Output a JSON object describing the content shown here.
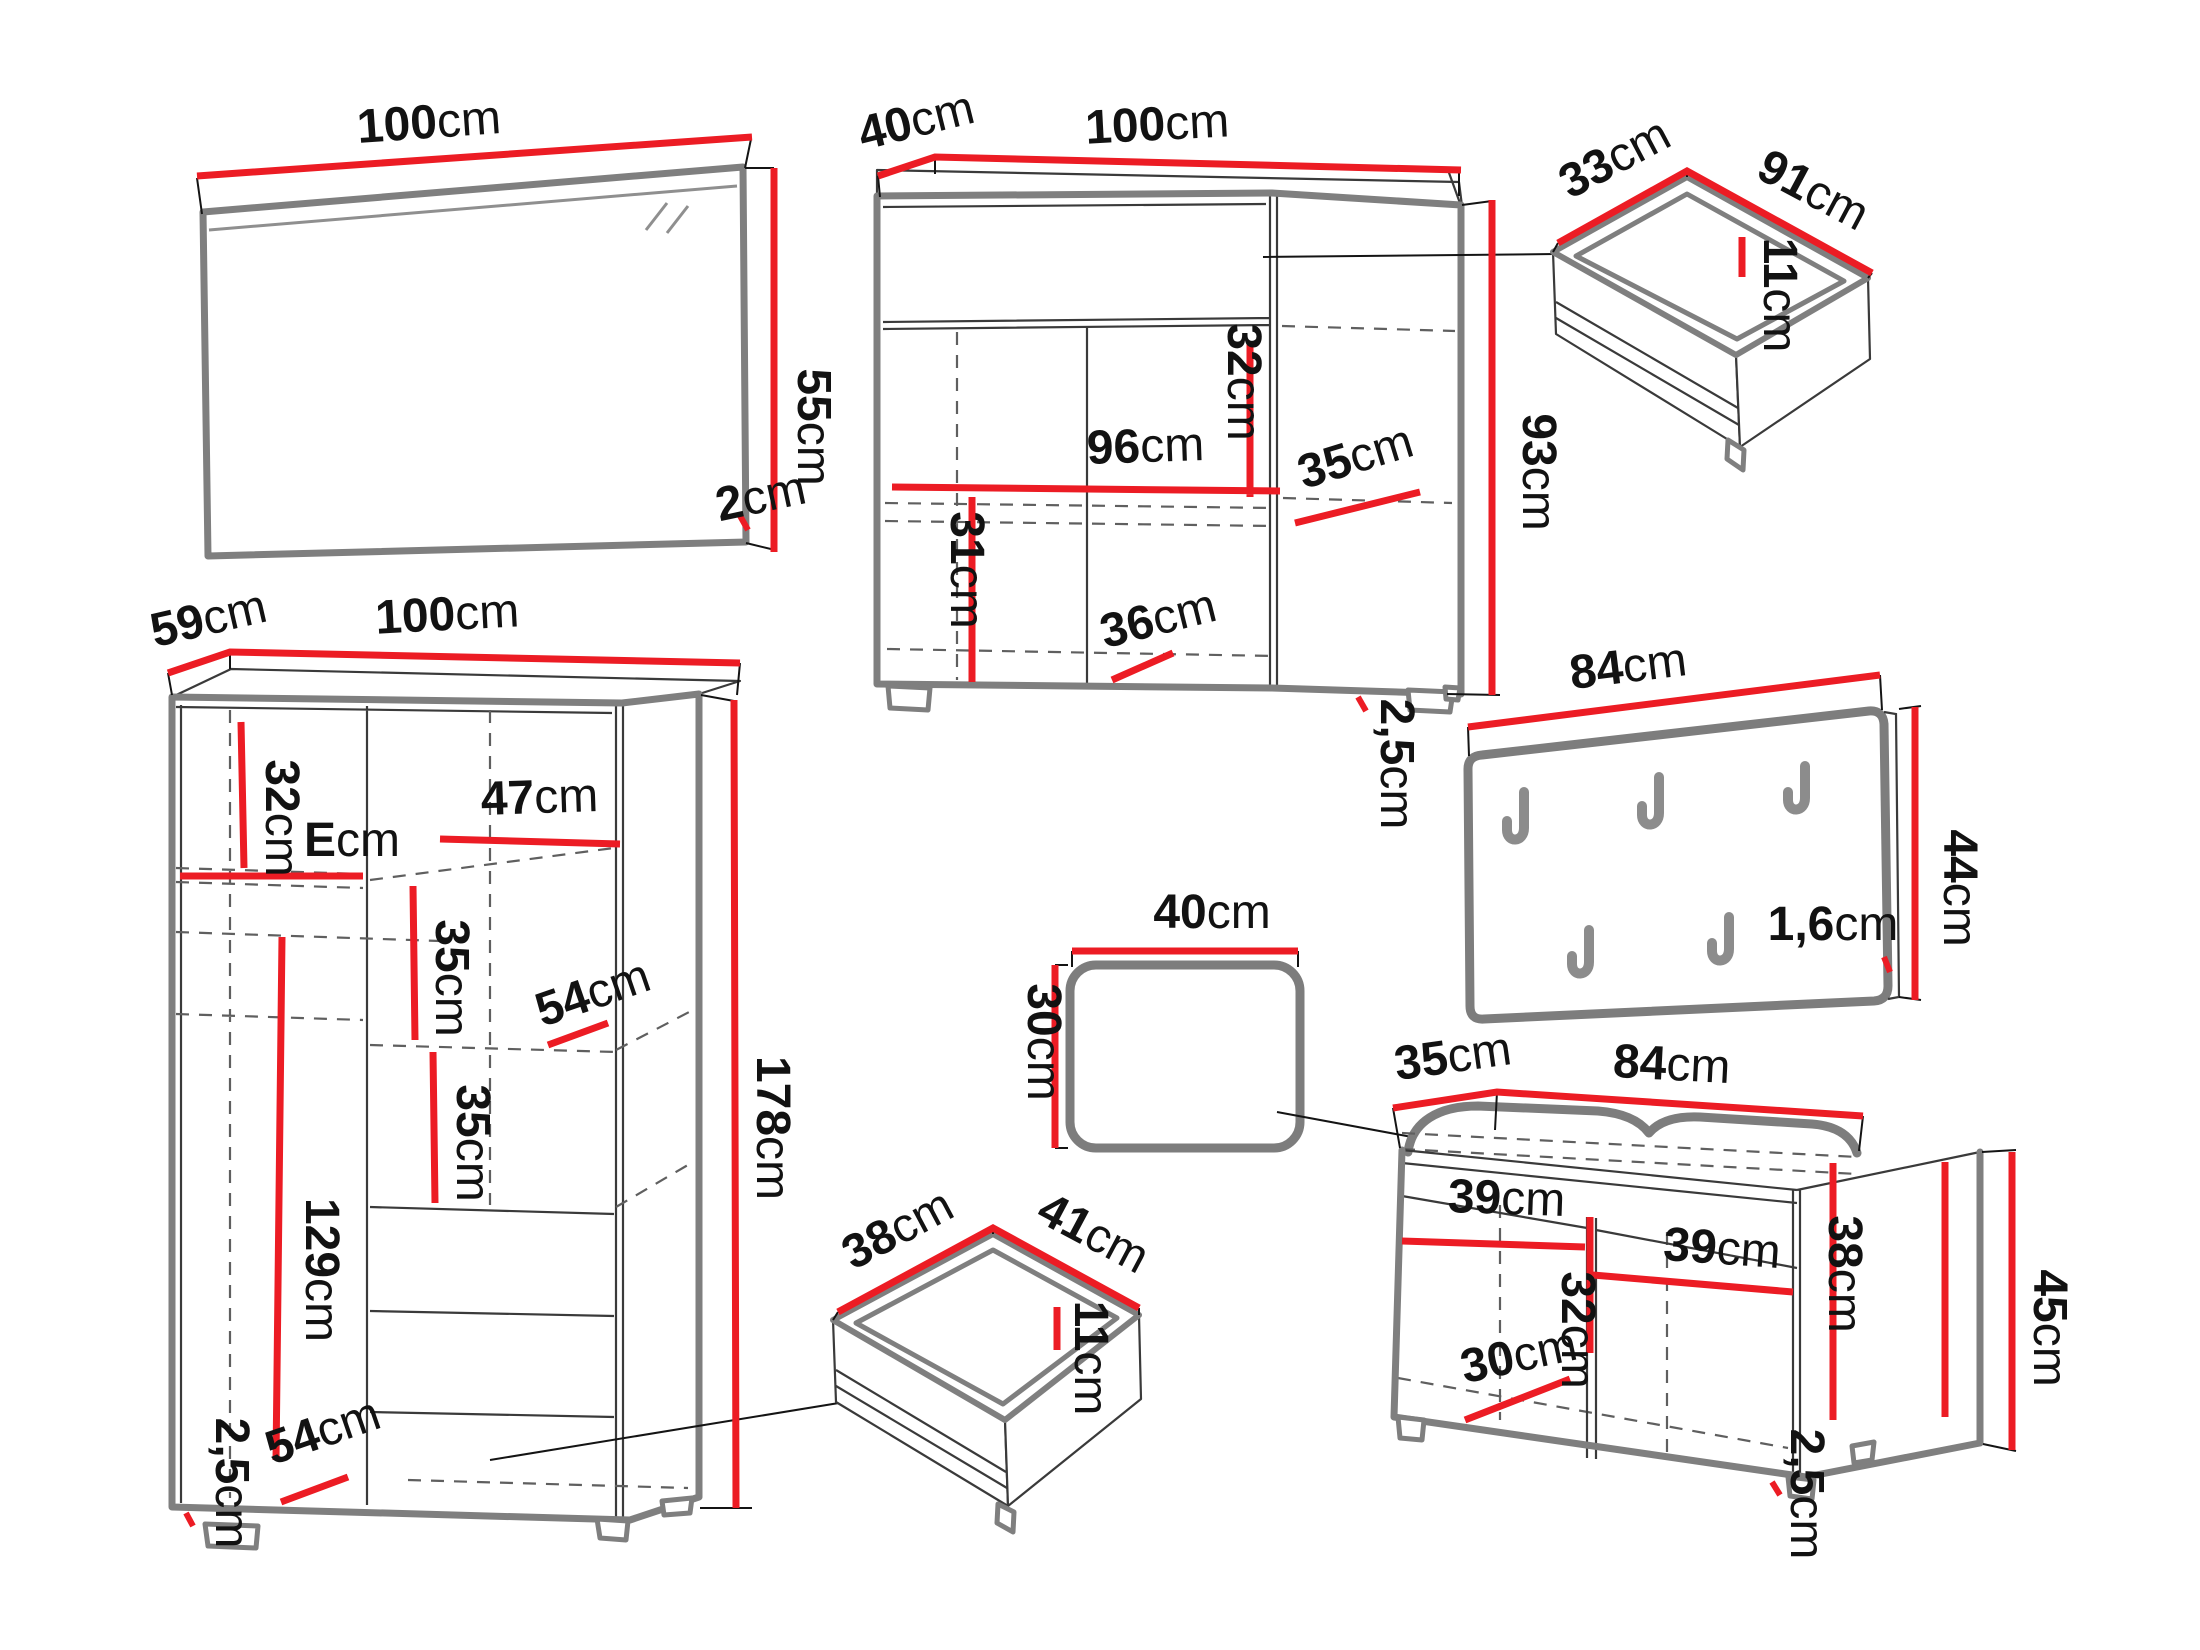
{
  "diagram": {
    "colors": {
      "dimension": "#ec1c24",
      "outline": "#7f7f7f",
      "detail": "#3a3a3a"
    },
    "mirror": {
      "width": {
        "v": "100",
        "u": "cm"
      },
      "height": {
        "v": "55",
        "u": "cm"
      },
      "thickness": {
        "v": "2",
        "u": "cm"
      }
    },
    "sideboard": {
      "depth": {
        "v": "40",
        "u": "cm"
      },
      "width": {
        "v": "100",
        "u": "cm"
      },
      "inner_width": {
        "v": "96",
        "u": "cm"
      },
      "top_inner_height": {
        "v": "32",
        "u": "cm"
      },
      "inner_depth": {
        "v": "35",
        "u": "cm"
      },
      "height": {
        "v": "93",
        "u": "cm"
      },
      "bottom_inner_height": {
        "v": "31",
        "u": "cm"
      },
      "bottom_inner_width": {
        "v": "36",
        "u": "cm"
      },
      "plinth": {
        "v": "2,5",
        "u": "cm"
      }
    },
    "drawer_top": {
      "depth": {
        "v": "33",
        "u": "cm"
      },
      "width": {
        "v": "91",
        "u": "cm"
      },
      "height": {
        "v": "11",
        "u": "cm"
      }
    },
    "coat_rack": {
      "width": {
        "v": "84",
        "u": "cm"
      },
      "height": {
        "v": "44",
        "u": "cm"
      },
      "thickness": {
        "v": "1,6",
        "u": "cm"
      }
    },
    "wardrobe": {
      "depth": {
        "v": "59",
        "u": "cm"
      },
      "width": {
        "v": "100",
        "u": "cm"
      },
      "top_shelf_height": {
        "v": "32",
        "u": "cm"
      },
      "left_width": {
        "v": "E",
        "u": "cm"
      },
      "right_width": {
        "v": "47",
        "u": "cm"
      },
      "shelf_gap_upper": {
        "v": "35",
        "u": "cm"
      },
      "shelf_depth_upper": {
        "v": "54",
        "u": "cm"
      },
      "shelf_gap_lower": {
        "v": "35",
        "u": "cm"
      },
      "hanging_height": {
        "v": "129",
        "u": "cm"
      },
      "height": {
        "v": "178",
        "u": "cm"
      },
      "shelf_depth_lower": {
        "v": "54",
        "u": "cm"
      },
      "plinth": {
        "v": "2,5",
        "u": "cm"
      }
    },
    "stool": {
      "width": {
        "v": "40",
        "u": "cm"
      },
      "height": {
        "v": "30",
        "u": "cm"
      }
    },
    "drawer_bottom": {
      "depth": {
        "v": "38",
        "u": "cm"
      },
      "width": {
        "v": "41",
        "u": "cm"
      },
      "height": {
        "v": "11",
        "u": "cm"
      }
    },
    "bench": {
      "depth": {
        "v": "35",
        "u": "cm"
      },
      "width": {
        "v": "84",
        "u": "cm"
      },
      "left_inner_width": {
        "v": "39",
        "u": "cm"
      },
      "right_inner_width": {
        "v": "39",
        "u": "cm"
      },
      "inner_height": {
        "v": "32",
        "u": "cm"
      },
      "inner_depth": {
        "v": "30",
        "u": "cm"
      },
      "side_inner_height": {
        "v": "38",
        "u": "cm"
      },
      "height": {
        "v": "45",
        "u": "cm"
      },
      "plinth": {
        "v": "2,5",
        "u": "cm"
      }
    }
  }
}
